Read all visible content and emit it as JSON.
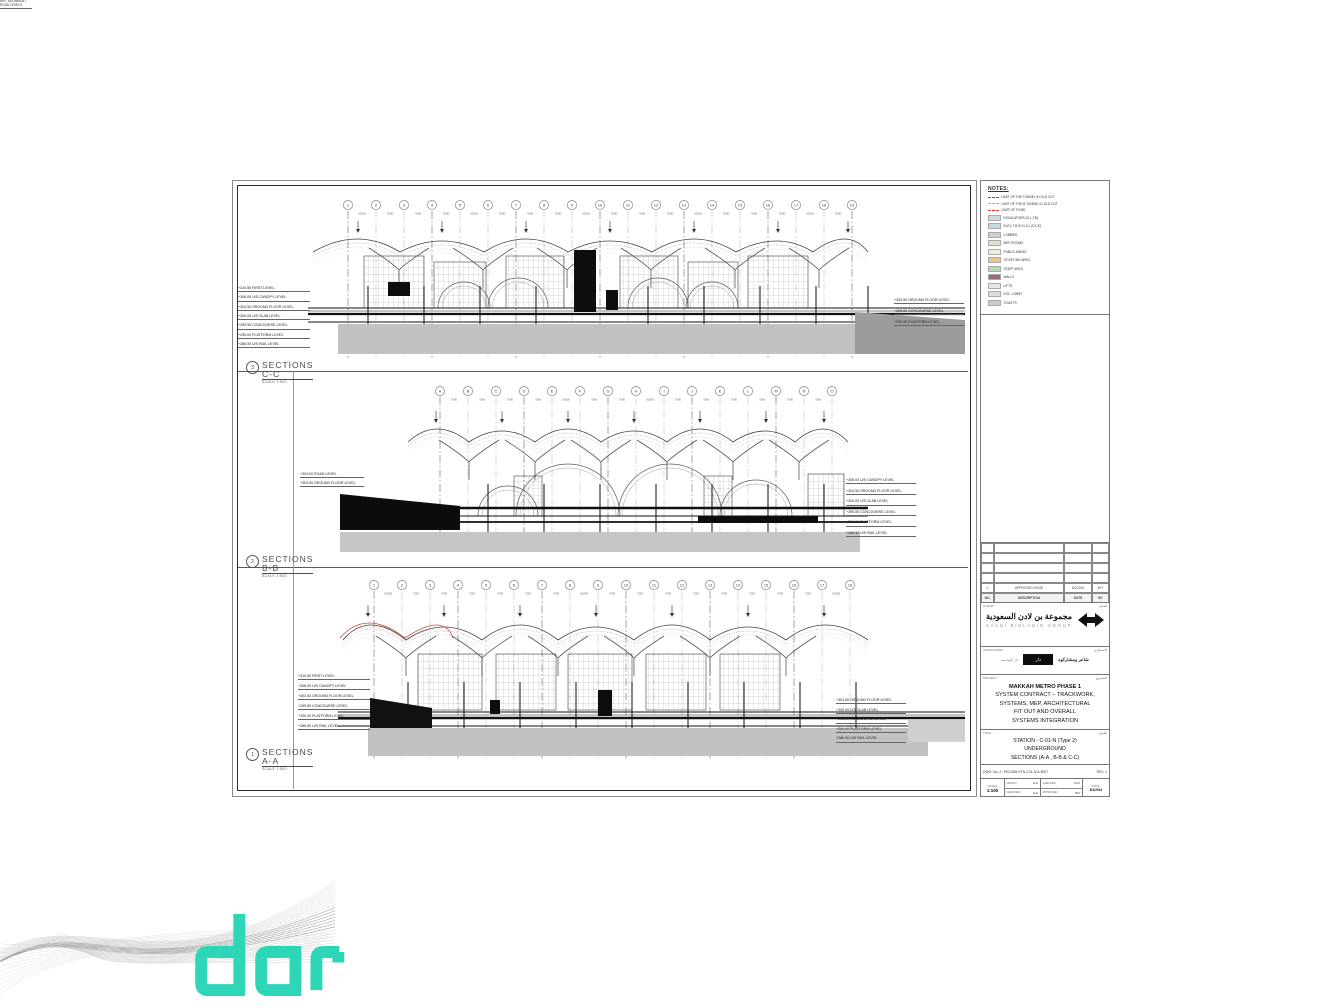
{
  "brand": {
    "logo_text": "dar",
    "teal": "#2dd6b6"
  },
  "legend": {
    "heading": "NOTES:",
    "entries": [
      {
        "type": "dash",
        "color": "#3a57c8",
        "label": "LIMIT OF THE TUNNEL ID GLD CUT"
      },
      {
        "type": "dash",
        "color": "#57c8e8",
        "label": "LIMIT OF THE B TUNNEL IG GLD CUT"
      },
      {
        "type": "dash",
        "color": "#cf3b2e",
        "label": "LIMIT OF TH-BD"
      },
      {
        "type": "box",
        "color": "#ccdadc",
        "label": "ESCALATORS (D-L-TB)"
      },
      {
        "type": "box",
        "color": "#c2dce0",
        "label": "ELEV T-B ID N-3-L (D-CE)"
      },
      {
        "type": "box",
        "color": "#ccd2d2",
        "label": "LOBBIES"
      },
      {
        "type": "box",
        "color": "#d4e6cc",
        "label": "MEP ROOMS"
      },
      {
        "type": "box",
        "color": "#f2eed2",
        "label": "PUBLIC AREAS"
      },
      {
        "type": "box",
        "color": "#eac592",
        "label": "TICKETING AREA"
      },
      {
        "type": "box",
        "color": "#bcd8b6",
        "label": "STAFF AREA"
      },
      {
        "type": "box",
        "color": "#9b6b70",
        "label": "WALLS"
      },
      {
        "type": "box",
        "color": "#e6e6e6",
        "label": "LIFTS"
      },
      {
        "type": "box",
        "color": "#dcdce6",
        "label": "ESC. LOBBY"
      },
      {
        "type": "box",
        "color": "#c6caca",
        "label": "TOILETS"
      }
    ]
  },
  "sheet": {
    "sections": [
      {
        "id": "C-C",
        "label_num": "3",
        "title": "SECTIONS C-C",
        "scale": "SCALE 1:500",
        "note": "REF. ALIGNMENT ROAD LEVELS",
        "grid_labels": [
          "1",
          "2",
          "3",
          "4",
          "5",
          "6",
          "7",
          "8",
          "9",
          "10",
          "11",
          "12",
          "13",
          "14",
          "15",
          "16",
          "17",
          "18",
          "19"
        ],
        "dims": [
          "10000",
          "7500",
          "7500",
          "7500",
          "10000",
          "7500",
          "7500",
          "7500",
          "10000",
          "7500",
          "7500",
          "7500",
          "10000",
          "7500",
          "7500",
          "7500",
          "10000",
          "7500"
        ],
        "levels_left": [
          "+310.50 FIRST LEVEL",
          "+306.00 U/S CANOPY LEVEL",
          "+303.50 GROUND FLOOR LEVEL",
          "+300.00 U/S SLAB LEVEL",
          "+295.50 CONCOURSE LEVEL",
          "+290.00 PLATFORM LEVEL",
          "+286.50 U/S RAIL LEVEL"
        ],
        "levels_right": [
          "+303.50 GROUND FLOOR LEVEL",
          "+295.50 CONCOURSE LEVEL",
          "+290.00 PLATFORM LEVEL"
        ]
      },
      {
        "id": "B-B",
        "label_num": "2",
        "title": "SECTIONS B-B",
        "scale": "SCALE 1:500",
        "grid_labels": [
          "A",
          "B",
          "C",
          "D",
          "E",
          "F",
          "G",
          "H",
          "I",
          "J",
          "K",
          "L",
          "M",
          "N",
          "O"
        ],
        "dims": [
          "7500",
          "7500",
          "7500",
          "7500",
          "10000",
          "7500",
          "7500",
          "10000",
          "7500",
          "7500",
          "7500",
          "7500",
          "7500",
          "7500"
        ],
        "levels_left": [
          "+304.00 ROAD LEVEL",
          "+303.50 GROUND FLOOR LEVEL"
        ],
        "levels_right": [
          "+306.00 U/S CANOPY LEVEL",
          "+303.50 GROUND FLOOR LEVEL",
          "+300.00 U/S SLAB LEVEL",
          "+295.50 CONCOURSE LEVEL",
          "+290.00 PLATFORM LEVEL",
          "+286.50 U/S RAIL LEVEL"
        ]
      },
      {
        "id": "A-A",
        "label_num": "1",
        "title": "SECTIONS A-A",
        "scale": "SCALE 1:500",
        "grid_labels": [
          "1",
          "2",
          "3",
          "4",
          "5",
          "6",
          "7",
          "8",
          "9",
          "10",
          "11",
          "12",
          "13",
          "14",
          "15",
          "16",
          "17",
          "18"
        ],
        "dims": [
          "10000",
          "7500",
          "7500",
          "7500",
          "7500",
          "7500",
          "7500",
          "10000",
          "7500",
          "7500",
          "7500",
          "7500",
          "7500",
          "7500",
          "7500",
          "7500",
          "10000"
        ],
        "levels_left": [
          "+310.50 FIRST LEVEL",
          "+306.00 U/S CANOPY LEVEL",
          "+303.50 GROUND FLOOR LEVEL",
          "+295.50 CONCOURSE LEVEL",
          "+290.00 PLATFORM LEVEL",
          "+286.50 U/S RAIL LEVEL"
        ],
        "levels_right": [
          "+303.50 GROUND FLOOR LEVEL",
          "+300.00 U/S SLAB LEVEL",
          "+295.50 CONCOURSE LEVEL",
          "+290.00 PLATFORM LEVEL",
          "+286.50 U/S RAIL LEVEL"
        ]
      }
    ]
  },
  "revision_table": {
    "rows": [
      [
        "",
        "",
        "",
        ""
      ],
      [
        "",
        "",
        "",
        ""
      ],
      [
        "",
        "",
        "",
        ""
      ],
      [
        "",
        "",
        "",
        ""
      ],
      [
        "0",
        "APPROVED ISSUE",
        "6/1/2014",
        "W.Y"
      ]
    ],
    "header": [
      "NO.",
      "DESCRIPTION",
      "DATE",
      "BY"
    ]
  },
  "client": {
    "label_en": "CLIENT :",
    "label_ar": "العميل",
    "name_ar": "مجموعة بن لادن السعودية",
    "name_en": "SAUDI BINLADIN GROUP"
  },
  "consultant": {
    "label_en": "CONSULTANT :",
    "label_ar": "الاستشاري",
    "left_ar": "دار الهندسة",
    "box": "دار",
    "right_ar": "شاعر ومشاركوه"
  },
  "project": {
    "label_en": "PROJECT :",
    "label_ar": "المشروع",
    "lines": [
      "MAKKAH METRO PHASE 1",
      "SYSTEM CONTRACT – TRACKWORK,",
      "SYSTEMS, MEP, ARCHITECTURAL",
      "FIT OUT AND OVERALL",
      "SYSTEMS INTEGRATION"
    ]
  },
  "drawing_title": {
    "label_en": "TITLE :",
    "label_ar": "العنوان",
    "lines": [
      "STATION - C-01-N (Type 2)",
      "UNDERGROUND",
      "SECTIONS (A-A , B-B & C-C)"
    ]
  },
  "drawing_number": {
    "left": "DWG. No. 2 : PK3-MM-STN-C01-N-A-5007",
    "right": "REV. 1"
  },
  "info": {
    "scale_label": "SCALE",
    "scale_value": "1:100",
    "drawn_label": "DRAWN",
    "drawn_value": "A.A.",
    "designed_label": "DESIGNED",
    "designed_value": "A.A.",
    "checked_label": "CHECKED",
    "checked_value": "N.O.",
    "approved_label": "APPROVED",
    "approved_value": "W.Y",
    "date_label": "DATE",
    "date_value": "6/1/2014"
  }
}
